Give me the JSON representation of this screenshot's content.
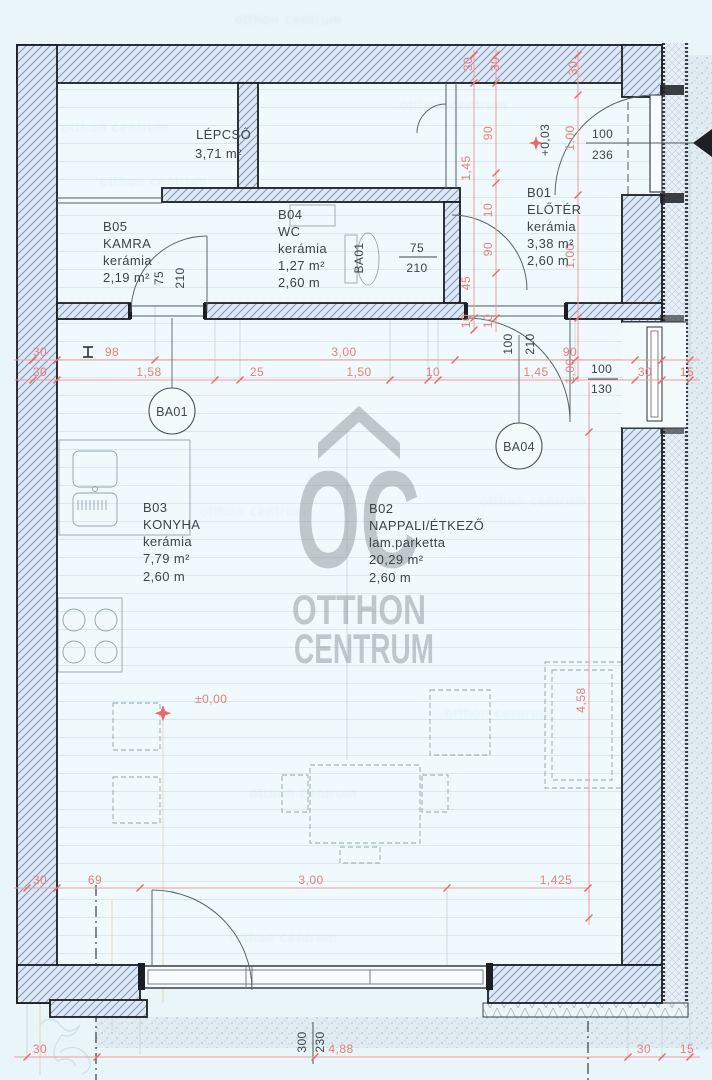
{
  "rooms": {
    "lepcso": {
      "lines": [
        "LÉPCSŐ",
        "3,71 m²"
      ]
    },
    "b05": {
      "lines": [
        "B05",
        "KAMRA",
        "kerámia",
        "2,19 m²"
      ]
    },
    "b04": {
      "lines": [
        "B04",
        "WC",
        "kerámia",
        "1,27 m²",
        "2,60 m"
      ]
    },
    "b01": {
      "lines": [
        "B01",
        "ELŐTÉR",
        "kerámia",
        "3,38 m²",
        "2,60 m"
      ]
    },
    "b03": {
      "lines": [
        "B03",
        "KONYHA",
        "kerámia",
        "7,79 m²",
        "2,60 m"
      ]
    },
    "b02": {
      "lines": [
        "B02",
        "NAPPALI/ÉTKEZŐ",
        "lam.parketta",
        "20,29 m²",
        "2,60 m"
      ]
    }
  },
  "openings": {
    "kamra_door": {
      "w": "75",
      "h": "210"
    },
    "wc_door": {
      "w": "75",
      "h": "210"
    },
    "eloter_door": {
      "w": "100",
      "h": "210"
    },
    "entry_door": {
      "w": "100",
      "h": "236"
    },
    "window_right": {
      "w": "100",
      "h": "130"
    },
    "terrace_door": {
      "w": "300",
      "h": "230"
    }
  },
  "levels": {
    "ground": "±0,00",
    "entry": "+0,03"
  },
  "tags": {
    "ba01": "BA01",
    "ba04": "BA04",
    "ba01_small": "BA01"
  },
  "dims": {
    "wall30_top": [
      "30",
      "30",
      "30"
    ],
    "chain_a": [
      "1,45",
      "45",
      "10"
    ],
    "chain_b": [
      "90",
      "10",
      "90",
      "10"
    ],
    "chain_right": [
      "1,00",
      "1,00",
      "1,00",
      "4,58"
    ],
    "row1": [
      "30",
      "98",
      "3,00",
      "90"
    ],
    "row2": [
      "30",
      "1,58",
      "25",
      "1,50",
      "10",
      "1,45",
      "30",
      "15"
    ],
    "bottom1": [
      "30",
      "69",
      "3,00",
      "1,425"
    ],
    "bottom2": [
      "30",
      "4,88",
      "30",
      "15"
    ]
  },
  "watermark": {
    "wordmark": "OC",
    "line1": "OTTHON",
    "line2": "CENTRUM",
    "faint": "otthon centrum"
  },
  "colors": {
    "dim_red": "#ec7b7b",
    "wall_line": "#1b1e22",
    "hatch": "#8495ad",
    "watermark_gray": "#8d979e"
  }
}
